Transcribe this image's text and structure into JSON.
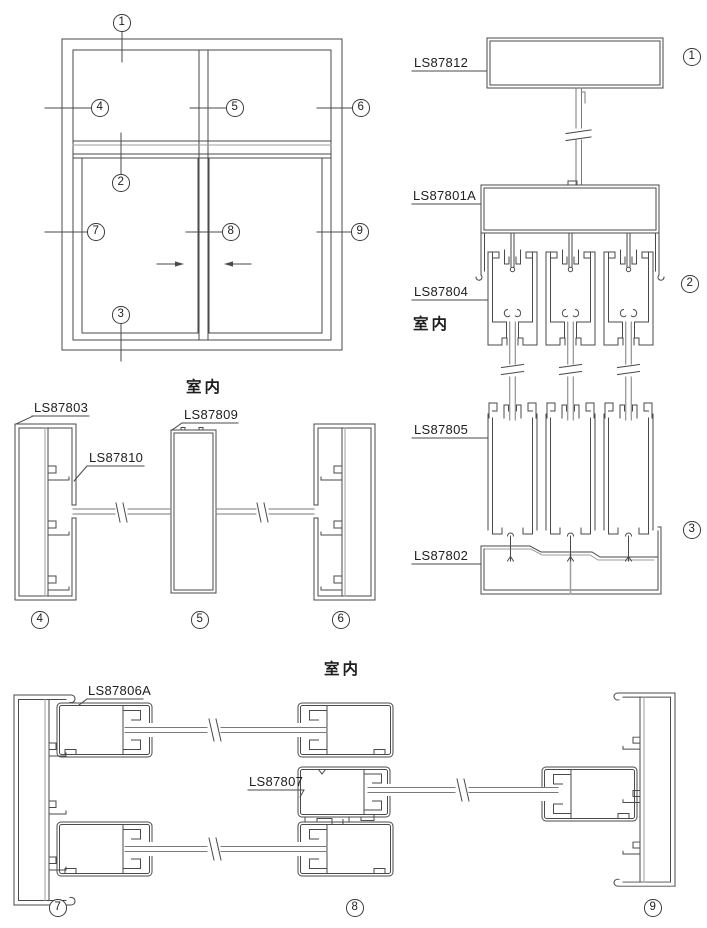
{
  "labels": {
    "interior": "室内",
    "ls87812": "LS87812",
    "ls87801a": "LS87801A",
    "ls87804": "LS87804",
    "ls87805": "LS87805",
    "ls87802": "LS87802",
    "ls87803": "LS87803",
    "ls87810": "LS87810",
    "ls87809": "LS87809",
    "ls87806a": "LS87806A",
    "ls87807": "LS87807"
  },
  "markers": {
    "n1": "1",
    "n2": "2",
    "n3": "3",
    "n4": "4",
    "n5": "5",
    "n6": "6",
    "n7": "7",
    "n8": "8",
    "n9": "9"
  }
}
